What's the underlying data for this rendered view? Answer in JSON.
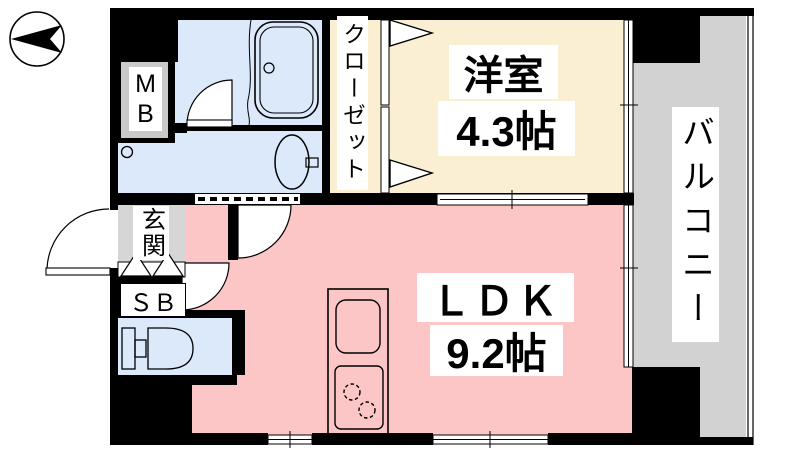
{
  "plan_title": "1LDK floor plan",
  "compass": {
    "icon": "north-arrow"
  },
  "rooms": {
    "western": {
      "name": "洋室",
      "size": "4.3帖",
      "color": "#faeed3"
    },
    "ldk": {
      "name": "ＬＤＫ",
      "size": "9.2帖",
      "color": "#fcc6c6"
    },
    "closet": {
      "name": "クローゼット",
      "color": "#faeed3"
    },
    "balcony": {
      "name": "バルコニー",
      "color": "#d2d2d2"
    },
    "genkan": {
      "name": "玄関",
      "color": "#d6d6d6"
    },
    "shoe_box": {
      "name": "ＳＢ"
    },
    "meter_box": {
      "name": "M\nB",
      "panel_color": "#c9c9c9"
    },
    "bathroom": {
      "color": "#dce9fa"
    },
    "washroom": {
      "color": "#dce9fa"
    },
    "toilet": {
      "color": "#dce9fa"
    }
  },
  "colors": {
    "wall": "#000000",
    "paper": "#ffffff"
  }
}
